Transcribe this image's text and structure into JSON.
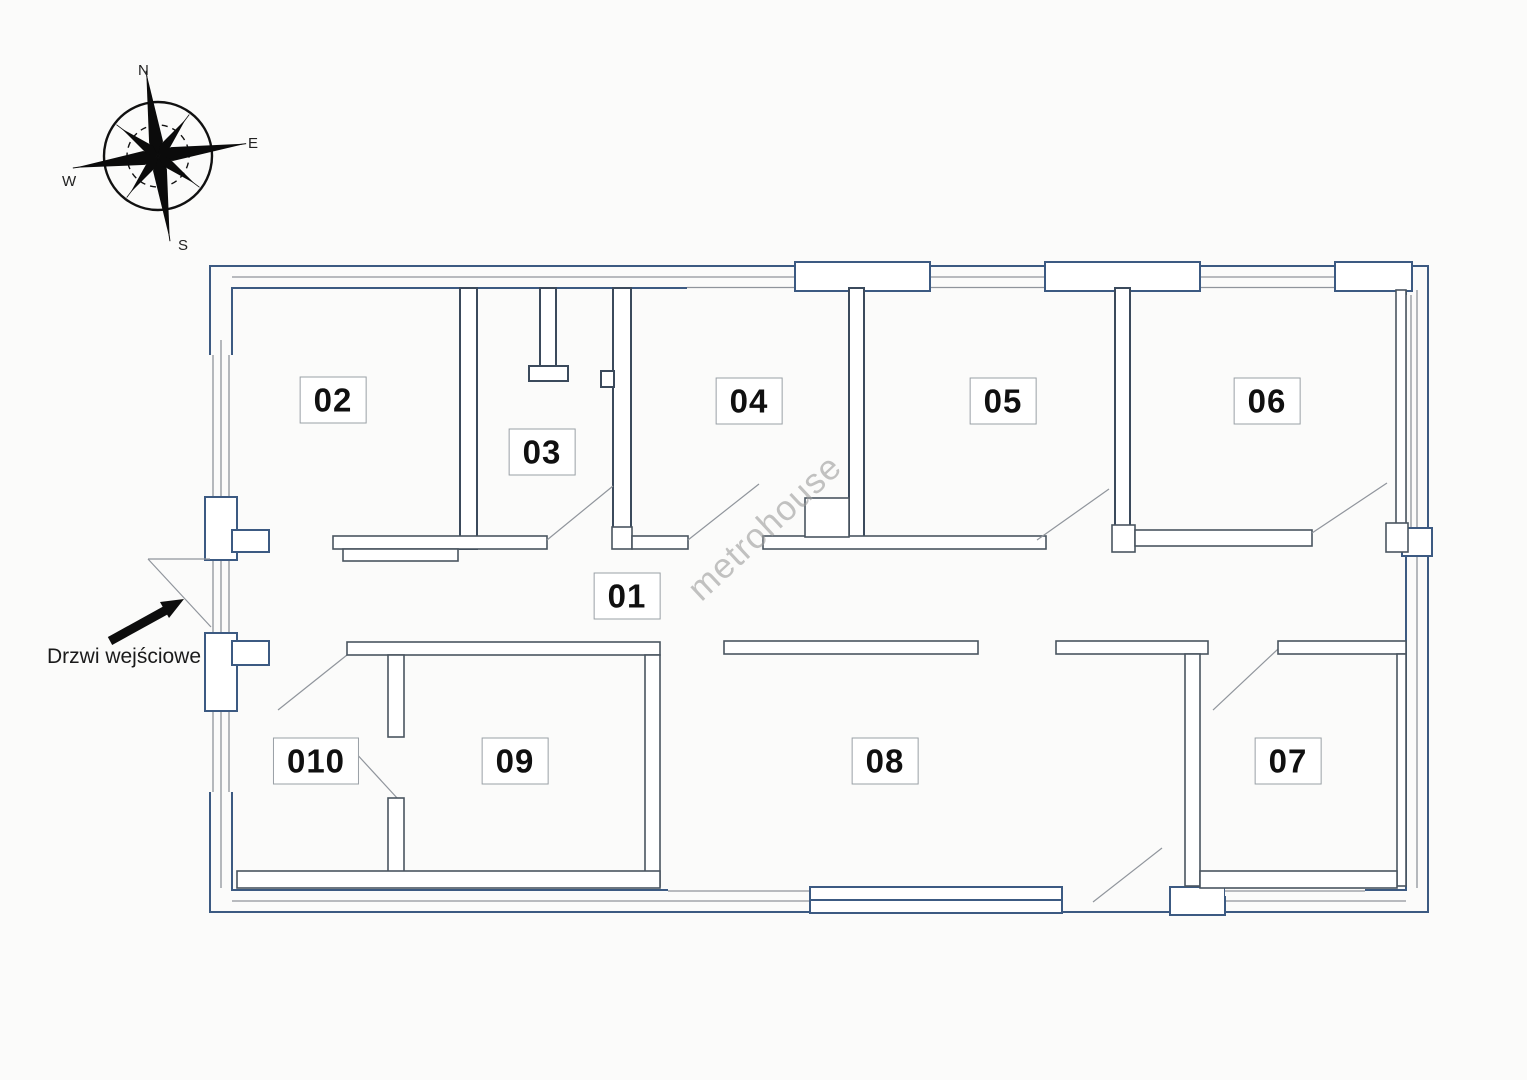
{
  "compass": {
    "north": "N",
    "east": "E",
    "south": "S",
    "west": "W"
  },
  "entrance": {
    "label": "Drzwi wejściowe"
  },
  "watermark": {
    "text": "metrohouse"
  },
  "rooms": [
    {
      "id": "room-01",
      "label": "01"
    },
    {
      "id": "room-02",
      "label": "02"
    },
    {
      "id": "room-03",
      "label": "03"
    },
    {
      "id": "room-04",
      "label": "04"
    },
    {
      "id": "room-05",
      "label": "05"
    },
    {
      "id": "room-06",
      "label": "06"
    },
    {
      "id": "room-07",
      "label": "07"
    },
    {
      "id": "room-08",
      "label": "08"
    },
    {
      "id": "room-09",
      "label": "09"
    },
    {
      "id": "room-010",
      "label": "010"
    }
  ],
  "colors": {
    "bg": "#fbfbfa",
    "wall_blue": "#3c5a82",
    "wall_dark": "#3b4a5c",
    "thin_wall": "#4a5560",
    "window_gray": "#8f949b",
    "swing_gray": "#90959c",
    "label_border": "#9aa0a6",
    "watermark_gray": "#9b9b9b",
    "arrow_black": "#0d0d0d"
  }
}
